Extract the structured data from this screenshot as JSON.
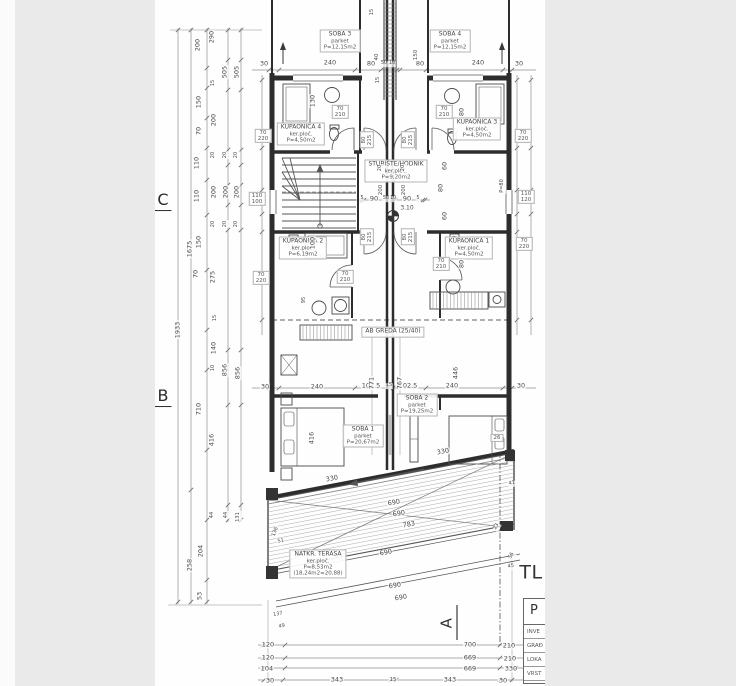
{
  "drawing_title_partial": "TL",
  "title_block": {
    "header": "P",
    "rows": [
      "INVE",
      "GRAĐ",
      "LOKA",
      "VRST"
    ]
  },
  "annotations": [
    {
      "k": "room",
      "n": "room-soba-3",
      "lines": [
        "SOBA  3",
        "parket",
        "P=12,15m2"
      ],
      "x": 340,
      "y": 41
    },
    {
      "k": "room",
      "n": "room-soba-4",
      "lines": [
        "SOBA  4",
        "parket",
        "P=12,15m2"
      ],
      "x": 450,
      "y": 41
    },
    {
      "k": "room",
      "n": "room-kupaonica-4",
      "lines": [
        "KUPAONICA  4",
        "ker.ploč.",
        "P=4,50m2"
      ],
      "x": 301,
      "y": 134
    },
    {
      "k": "room",
      "n": "room-kupaonica-3",
      "lines": [
        "KUPAONICA  3",
        "ker.ploč.",
        "P=4,50m2"
      ],
      "x": 477,
      "y": 129
    },
    {
      "k": "room",
      "n": "room-stubiste-hodnik",
      "lines": [
        "STUBIŠTE/HODNIK",
        "ker.ploč.",
        "P=9,20m2"
      ],
      "x": 396,
      "y": 171
    },
    {
      "k": "room",
      "n": "room-kupaonica-2",
      "lines": [
        "KUPAONICA  2",
        "ker.ploč.",
        "P=6,19m2"
      ],
      "x": 303,
      "y": 248
    },
    {
      "k": "room",
      "n": "room-kupaonica-1",
      "lines": [
        "KUPAONICA  1",
        "ker.ploč.",
        "P=4,50m2"
      ],
      "x": 469,
      "y": 248
    },
    {
      "k": "room",
      "n": "room-soba-1",
      "lines": [
        "SOBA  1",
        "parket",
        "P=20,67m2"
      ],
      "x": 363,
      "y": 436
    },
    {
      "k": "room",
      "n": "room-soba-2",
      "lines": [
        "SOBA  2",
        "parket",
        "P=19,25m2"
      ],
      "x": 417,
      "y": 405
    },
    {
      "k": "room",
      "n": "room-natkrivena-terasa",
      "lines": [
        "NATKR.  TERASA",
        "ker.ploč.",
        "P=8,53m2",
        "(18,24m2=20,88)"
      ],
      "x": 318,
      "y": 564
    },
    {
      "k": "room",
      "n": "beam-label-ab-greda-25-40",
      "lines": [
        "AB GREDA (25/40)"
      ],
      "x": 393,
      "y": 332
    },
    {
      "k": "tag",
      "lines": [
        "70",
        "210"
      ],
      "x": 340,
      "y": 112
    },
    {
      "k": "tag",
      "lines": [
        "70",
        "220"
      ],
      "x": 263,
      "y": 136
    },
    {
      "k": "tag",
      "lines": [
        "70",
        "210"
      ],
      "x": 444,
      "y": 112
    },
    {
      "k": "tag",
      "lines": [
        "70",
        "220"
      ],
      "x": 523,
      "y": 136
    },
    {
      "k": "tag",
      "lines": [
        "70",
        "210"
      ],
      "x": 345,
      "y": 277
    },
    {
      "k": "tag",
      "lines": [
        "70",
        "220"
      ],
      "x": 261,
      "y": 278
    },
    {
      "k": "tag",
      "lines": [
        "70",
        "210"
      ],
      "x": 441,
      "y": 264
    },
    {
      "k": "tag",
      "lines": [
        "70",
        "220"
      ],
      "x": 524,
      "y": 244
    },
    {
      "k": "tag",
      "lines": [
        "110",
        "100"
      ],
      "x": 257,
      "y": 199
    },
    {
      "k": "tag",
      "lines": [
        "110",
        "120"
      ],
      "x": 526,
      "y": 197
    },
    {
      "k": "tag",
      "lines": [
        "80",
        "215"
      ],
      "x": 367,
      "y": 140,
      "r": -90
    },
    {
      "k": "tag",
      "lines": [
        "80",
        "215"
      ],
      "x": 408,
      "y": 140,
      "r": -90
    },
    {
      "k": "tag",
      "lines": [
        "80",
        "215"
      ],
      "x": 367,
      "y": 237,
      "r": -90
    },
    {
      "k": "tag",
      "lines": [
        "80",
        "215"
      ],
      "x": 408,
      "y": 237,
      "r": -90
    },
    {
      "k": "tag",
      "lines": [
        "26"
      ],
      "x": 497,
      "y": 438
    },
    {
      "k": "grid",
      "n": "grid-axis-c",
      "t": "C",
      "x": 163,
      "y": 201
    },
    {
      "k": "grid",
      "n": "grid-axis-b",
      "t": "B",
      "x": 163,
      "y": 397
    },
    {
      "k": "big",
      "n": "drawing-title-partial-text",
      "t": "TL",
      "x": 531,
      "y": 573
    },
    {
      "k": "big",
      "n": "section-marker-a",
      "t": "A",
      "x": 447,
      "y": 623,
      "r": -90,
      "s": 15
    },
    {
      "k": "dim",
      "t": "30",
      "x": 264,
      "y": 64
    },
    {
      "k": "dim",
      "t": "240",
      "x": 330,
      "y": 63
    },
    {
      "k": "dim",
      "t": "80",
      "x": 371,
      "y": 64
    },
    {
      "k": "dim",
      "t": "50",
      "x": 384,
      "y": 64,
      "s": 5
    },
    {
      "k": "dim",
      "t": "10",
      "x": 392,
      "y": 64,
      "s": 5
    },
    {
      "k": "dim",
      "t": "80",
      "x": 420,
      "y": 64
    },
    {
      "k": "dim",
      "t": "240",
      "x": 478,
      "y": 63
    },
    {
      "k": "dim",
      "t": "30",
      "x": 519,
      "y": 64
    },
    {
      "k": "dim",
      "t": "15",
      "x": 373,
      "y": 12,
      "r": -90,
      "s": 5
    },
    {
      "k": "dim",
      "t": "40",
      "x": 377,
      "y": 57,
      "r": -90,
      "s": 5.5
    },
    {
      "k": "dim",
      "t": "150",
      "x": 416,
      "y": 55,
      "r": -90,
      "s": 5.5
    },
    {
      "k": "dim",
      "t": "15",
      "x": 379,
      "y": 80,
      "r": -90,
      "s": 5
    },
    {
      "k": "dim",
      "t": "130",
      "x": 313,
      "y": 101,
      "r": -90
    },
    {
      "k": "dim",
      "t": "80",
      "x": 462,
      "y": 112,
      "r": -90
    },
    {
      "k": "dim",
      "t": "200",
      "x": 381,
      "y": 190,
      "r": -90,
      "s": 5.5
    },
    {
      "k": "dim",
      "t": "200",
      "x": 404,
      "y": 190,
      "r": -90,
      "s": 5.5
    },
    {
      "k": "dim",
      "t": "20",
      "x": 381,
      "y": 168,
      "r": -90,
      "s": 5
    },
    {
      "k": "dim",
      "t": "20",
      "x": 404,
      "y": 168,
      "r": -90,
      "s": 5
    },
    {
      "k": "dim",
      "t": "60",
      "x": 445,
      "y": 166,
      "r": -90
    },
    {
      "k": "dim",
      "t": "80",
      "x": 441,
      "y": 188,
      "r": -90
    },
    {
      "k": "dim",
      "t": "60",
      "x": 445,
      "y": 216,
      "r": -90
    },
    {
      "k": "dim",
      "t": "P=80",
      "x": 503,
      "y": 186,
      "r": -90,
      "s": 5
    },
    {
      "k": "dim",
      "t": "100",
      "x": 313,
      "y": 243,
      "r": -90
    },
    {
      "k": "dim",
      "t": "95",
      "x": 305,
      "y": 300,
      "r": -90,
      "s": 5
    },
    {
      "k": "dim",
      "t": "80",
      "x": 462,
      "y": 264,
      "r": -90
    },
    {
      "k": "dim",
      "t": "5",
      "x": 362,
      "y": 199,
      "s": 5
    },
    {
      "k": "dim",
      "t": "90",
      "x": 374,
      "y": 199
    },
    {
      "k": "dim",
      "t": "50",
      "x": 386,
      "y": 199,
      "s": 5
    },
    {
      "k": "dim",
      "t": "10",
      "x": 393,
      "y": 199,
      "s": 5
    },
    {
      "k": "dim",
      "t": "90",
      "x": 407,
      "y": 199
    },
    {
      "k": "dim",
      "t": "5",
      "x": 418,
      "y": 199,
      "s": 5
    },
    {
      "k": "dim",
      "t": "3.10",
      "x": 407,
      "y": 209,
      "s": 6
    },
    {
      "k": "dim",
      "t": "30",
      "x": 265,
      "y": 387
    },
    {
      "k": "dim",
      "t": "240",
      "x": 317,
      "y": 387
    },
    {
      "k": "dim",
      "t": "102.5",
      "x": 371,
      "y": 386
    },
    {
      "k": "dim",
      "t": "15",
      "x": 389,
      "y": 386,
      "s": 5
    },
    {
      "k": "dim",
      "t": "102.5",
      "x": 408,
      "y": 386
    },
    {
      "k": "dim",
      "t": "240",
      "x": 452,
      "y": 386
    },
    {
      "k": "dim",
      "t": "30",
      "x": 521,
      "y": 386
    },
    {
      "k": "dim",
      "t": "416",
      "x": 312,
      "y": 438,
      "r": -90
    },
    {
      "k": "dim",
      "t": "446",
      "x": 456,
      "y": 373,
      "r": -90
    },
    {
      "k": "dim",
      "t": "771",
      "x": 372,
      "y": 383,
      "r": -90
    },
    {
      "k": "dim",
      "t": "767",
      "x": 400,
      "y": 383,
      "r": -90
    },
    {
      "k": "dim",
      "t": "330",
      "x": 332,
      "y": 479,
      "r": -11
    },
    {
      "k": "dim",
      "t": "330",
      "x": 443,
      "y": 452,
      "r": -11
    },
    {
      "k": "dim",
      "t": "690",
      "x": 394,
      "y": 503,
      "r": -11
    },
    {
      "k": "dim",
      "t": "690",
      "x": 399,
      "y": 514,
      "r": -11
    },
    {
      "k": "dim",
      "t": "783",
      "x": 409,
      "y": 525,
      "r": -11
    },
    {
      "k": "dim",
      "t": "690",
      "x": 386,
      "y": 553,
      "r": -11
    },
    {
      "k": "dim",
      "t": "690",
      "x": 395,
      "y": 586,
      "r": -11
    },
    {
      "k": "dim",
      "t": "690",
      "x": 401,
      "y": 598,
      "r": -11
    },
    {
      "k": "dim",
      "t": "136",
      "x": 276,
      "y": 532,
      "r": -70,
      "s": 5
    },
    {
      "k": "dim",
      "t": "51",
      "x": 281,
      "y": 542,
      "r": -11,
      "s": 5
    },
    {
      "k": "dim",
      "t": "137",
      "x": 278,
      "y": 615,
      "r": -11,
      "s": 5
    },
    {
      "k": "dim",
      "t": "49",
      "x": 282,
      "y": 627,
      "r": -11,
      "s": 5
    },
    {
      "k": "dim",
      "t": "56",
      "x": 512,
      "y": 556,
      "r": -60,
      "s": 5
    },
    {
      "k": "dim",
      "t": "45",
      "x": 511,
      "y": 567,
      "r": -11,
      "s": 5
    },
    {
      "k": "dim",
      "t": "41",
      "x": 512,
      "y": 484,
      "r": -11,
      "s": 5
    },
    {
      "k": "dim",
      "t": "23",
      "x": 497,
      "y": 527,
      "r": -60,
      "s": 5
    },
    {
      "k": "dim",
      "t": "120",
      "x": 268,
      "y": 645
    },
    {
      "k": "dim",
      "t": "700",
      "x": 470,
      "y": 645
    },
    {
      "k": "dim",
      "t": "210",
      "x": 509,
      "y": 646
    },
    {
      "k": "dim",
      "t": "120",
      "x": 268,
      "y": 658
    },
    {
      "k": "dim",
      "t": "669",
      "x": 470,
      "y": 658
    },
    {
      "k": "dim",
      "t": "210",
      "x": 510,
      "y": 659
    },
    {
      "k": "dim",
      "t": "104",
      "x": 267,
      "y": 669
    },
    {
      "k": "dim",
      "t": "669",
      "x": 470,
      "y": 669
    },
    {
      "k": "dim",
      "t": "330",
      "x": 511,
      "y": 669
    },
    {
      "k": "dim",
      "t": "30",
      "x": 270,
      "y": 681
    },
    {
      "k": "dim",
      "t": "343",
      "x": 337,
      "y": 680
    },
    {
      "k": "dim",
      "t": "15",
      "x": 393,
      "y": 680,
      "s": 5.5
    },
    {
      "k": "dim",
      "t": "343",
      "x": 450,
      "y": 680
    },
    {
      "k": "dim",
      "t": "30",
      "x": 503,
      "y": 681
    },
    {
      "k": "dim",
      "t": "1933",
      "x": 178,
      "y": 330,
      "r": -90
    },
    {
      "k": "dim",
      "t": "1675",
      "x": 190,
      "y": 249,
      "r": -90
    },
    {
      "k": "dim",
      "t": "258",
      "x": 190,
      "y": 565,
      "r": -90
    },
    {
      "k": "dim",
      "t": "200",
      "x": 198,
      "y": 45,
      "r": -90
    },
    {
      "k": "dim",
      "t": "290",
      "x": 212,
      "y": 37,
      "r": -90
    },
    {
      "k": "dim",
      "t": "505",
      "x": 225,
      "y": 72,
      "r": -90
    },
    {
      "k": "dim",
      "t": "505",
      "x": 237,
      "y": 72,
      "r": -90
    },
    {
      "k": "dim",
      "t": "15",
      "x": 214,
      "y": 83,
      "r": -90,
      "s": 5
    },
    {
      "k": "dim",
      "t": "150",
      "x": 199,
      "y": 102,
      "r": -90
    },
    {
      "k": "dim",
      "t": "200",
      "x": 214,
      "y": 120,
      "r": -90
    },
    {
      "k": "dim",
      "t": "70",
      "x": 199,
      "y": 131,
      "r": -90
    },
    {
      "k": "dim",
      "t": "20",
      "x": 214,
      "y": 155,
      "r": -90,
      "s": 5
    },
    {
      "k": "dim",
      "t": "20",
      "x": 226,
      "y": 155,
      "r": -90,
      "s": 5
    },
    {
      "k": "dim",
      "t": "20",
      "x": 237,
      "y": 155,
      "r": -90,
      "s": 5
    },
    {
      "k": "dim",
      "t": "110",
      "x": 197,
      "y": 163,
      "r": -90
    },
    {
      "k": "dim",
      "t": "200",
      "x": 214,
      "y": 192,
      "r": -90
    },
    {
      "k": "dim",
      "t": "200",
      "x": 226,
      "y": 192,
      "r": -90
    },
    {
      "k": "dim",
      "t": "200",
      "x": 237,
      "y": 192,
      "r": -90
    },
    {
      "k": "dim",
      "t": "20",
      "x": 214,
      "y": 224,
      "r": -90,
      "s": 5
    },
    {
      "k": "dim",
      "t": "20",
      "x": 226,
      "y": 224,
      "r": -90,
      "s": 5
    },
    {
      "k": "dim",
      "t": "20",
      "x": 237,
      "y": 224,
      "r": -90,
      "s": 5
    },
    {
      "k": "dim",
      "t": "110",
      "x": 197,
      "y": 196,
      "r": -90
    },
    {
      "k": "dim",
      "t": "150",
      "x": 199,
      "y": 242,
      "r": -90
    },
    {
      "k": "dim",
      "t": "275",
      "x": 213,
      "y": 277,
      "r": -90
    },
    {
      "k": "dim",
      "t": "70",
      "x": 196,
      "y": 274,
      "r": -90
    },
    {
      "k": "dim",
      "t": "15",
      "x": 216,
      "y": 318,
      "r": -90,
      "s": 5
    },
    {
      "k": "dim",
      "t": "140",
      "x": 214,
      "y": 348,
      "r": -90
    },
    {
      "k": "dim",
      "t": "10",
      "x": 214,
      "y": 368,
      "r": -90,
      "s": 5
    },
    {
      "k": "dim",
      "t": "856",
      "x": 225,
      "y": 370,
      "r": -90
    },
    {
      "k": "dim",
      "t": "856",
      "x": 238,
      "y": 373,
      "r": -90
    },
    {
      "k": "dim",
      "t": "710",
      "x": 199,
      "y": 409,
      "r": -90
    },
    {
      "k": "dim",
      "t": "416",
      "x": 212,
      "y": 440,
      "r": -90
    },
    {
      "k": "dim",
      "t": "44",
      "x": 213,
      "y": 515,
      "r": -90,
      "s": 5
    },
    {
      "k": "dim",
      "t": "44",
      "x": 227,
      "y": 515,
      "r": -90,
      "s": 5
    },
    {
      "k": "dim",
      "t": "131",
      "x": 239,
      "y": 517,
      "r": -90,
      "s": 5
    },
    {
      "k": "dim",
      "t": "204",
      "x": 201,
      "y": 551,
      "r": -90
    },
    {
      "k": "dim",
      "t": "53",
      "x": 200,
      "y": 596,
      "r": -90
    }
  ]
}
